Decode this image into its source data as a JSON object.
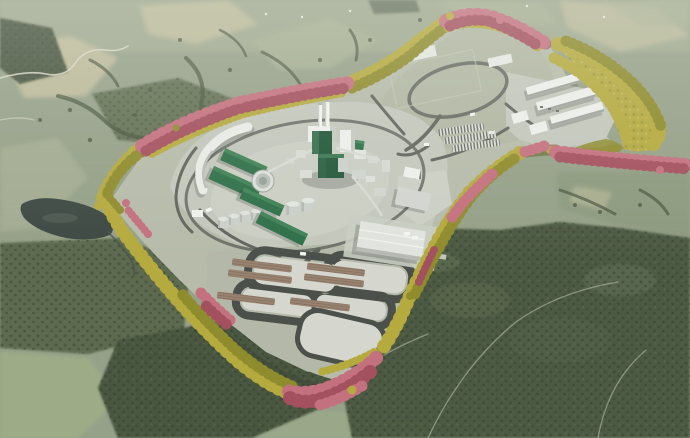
{
  "scene": {
    "type": "aerial-3d-render",
    "description": "Bird's-eye 3D visualization of a large industrial plant on a cleared plateau ringed by a buffer of pink and yellow autumn trees, set in a rural landscape of field patchwork, dark forest and a small pond.",
    "elements": [
      "rural landscape field patchwork",
      "dark forest areas",
      "small pond",
      "cleared plant site platform",
      "perimeter tree buffer pink",
      "perimeter tree buffer yellow",
      "mill core with twin chimney stacks",
      "green process buildings",
      "curved storage building",
      "circular treatment basin",
      "storage tank row",
      "log storage piles with loop roads",
      "white warehouse rows",
      "oval turning loop road",
      "internal roads",
      "empty gravel pad"
    ]
  },
  "colors": {
    "terrain_base": "#96a189",
    "terrain_light": "#a8b195",
    "field_tan": "#c6c1a0",
    "field_green": "#9fae86",
    "field_meadow": "#9aa889",
    "field_rmid": "#8d9a7f",
    "field_pad": "#b1b7a3",
    "forest_dark": "#49563f",
    "forest_mid": "#5d6b50",
    "pond": "#3e4943",
    "site_ground": "#b6bbaa",
    "apron_gray": "#c3c7bc",
    "pad_white": "#e7e9e4",
    "pad_light": "#d5d7cf",
    "road_dark": "#62665f",
    "asphalt": "#4b504b",
    "band_under_olive": "#6c7038",
    "band_under_rose": "#96565e",
    "tree_yellow": "#b5aa3e",
    "tree_yellow_dark": "#8f8c2e",
    "tree_pink": "#c4717f",
    "tree_pink_dark": "#a4515f",
    "building_green": "#2f7049",
    "building_green_dark": "#24583a",
    "building_green_light": "#418257",
    "building_white": "#edefeb",
    "building_gray": "#d3d6d0",
    "stack_white": "#f3f4f1",
    "tank_gray": "#cbcfca",
    "log_brown": "#9a8371",
    "log_brown_dark": "#7c685a",
    "shadow": "#2a2f2a",
    "haze": "#eef0e8"
  }
}
